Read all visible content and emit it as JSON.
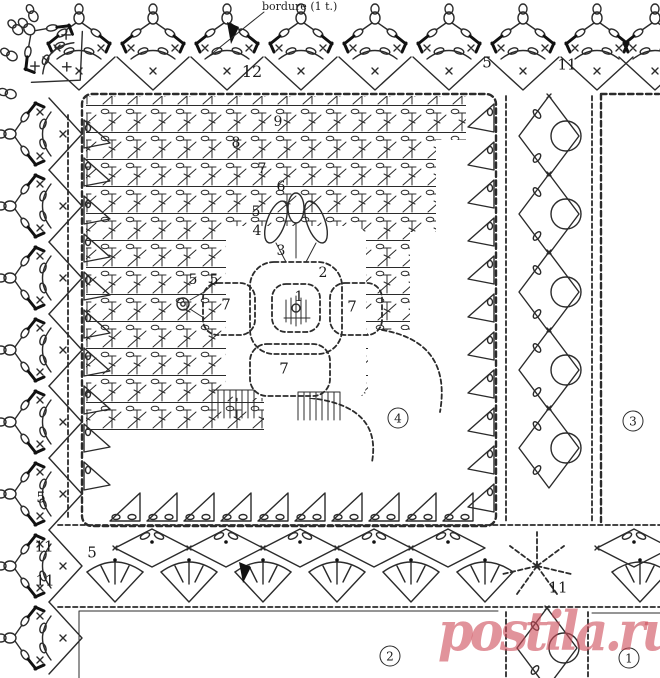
{
  "diagram": {
    "kind": "crochet pattern chart",
    "bordure_label": "bordure (1 t.)",
    "watermark": {
      "text": "postila.ru",
      "color": "rgba(205,75,88,0.6)"
    },
    "circled_motif_numbers": [
      {
        "text": "4",
        "x": 398,
        "y": 418
      },
      {
        "text": "3",
        "x": 633,
        "y": 421
      },
      {
        "text": "2",
        "x": 390,
        "y": 656
      },
      {
        "text": "1",
        "x": 629,
        "y": 658
      }
    ],
    "number_labels": [
      {
        "text": "12",
        "x": 252,
        "y": 72,
        "size": 16
      },
      {
        "text": "9",
        "x": 278,
        "y": 122,
        "size": 14
      },
      {
        "text": "8",
        "x": 236,
        "y": 143,
        "size": 14
      },
      {
        "text": "7",
        "x": 262,
        "y": 169,
        "size": 14
      },
      {
        "text": "6",
        "x": 281,
        "y": 187,
        "size": 14
      },
      {
        "text": "5",
        "x": 256,
        "y": 212,
        "size": 14
      },
      {
        "text": "4",
        "x": 257,
        "y": 231,
        "size": 14
      },
      {
        "text": "3",
        "x": 281,
        "y": 251,
        "size": 14
      },
      {
        "text": "2",
        "x": 323,
        "y": 273,
        "size": 14
      },
      {
        "text": "1",
        "x": 299,
        "y": 297,
        "size": 14
      },
      {
        "text": "5",
        "x": 193,
        "y": 280,
        "size": 14
      },
      {
        "text": "5",
        "x": 214,
        "y": 280,
        "size": 14
      },
      {
        "text": "7",
        "x": 226,
        "y": 305,
        "size": 15
      },
      {
        "text": "7",
        "x": 352,
        "y": 307,
        "size": 15
      },
      {
        "text": "7",
        "x": 284,
        "y": 369,
        "size": 15
      },
      {
        "text": "5",
        "x": 487,
        "y": 63,
        "size": 15
      },
      {
        "text": "11",
        "x": 567,
        "y": 65,
        "size": 15
      },
      {
        "text": "5",
        "x": 41,
        "y": 498,
        "size": 15
      },
      {
        "text": "11",
        "x": 44,
        "y": 547,
        "size": 15
      },
      {
        "text": "5",
        "x": 92,
        "y": 553,
        "size": 15
      },
      {
        "text": "11",
        "x": 45,
        "y": 581,
        "size": 15
      },
      {
        "text": "11",
        "x": 558,
        "y": 588,
        "size": 15
      }
    ]
  }
}
